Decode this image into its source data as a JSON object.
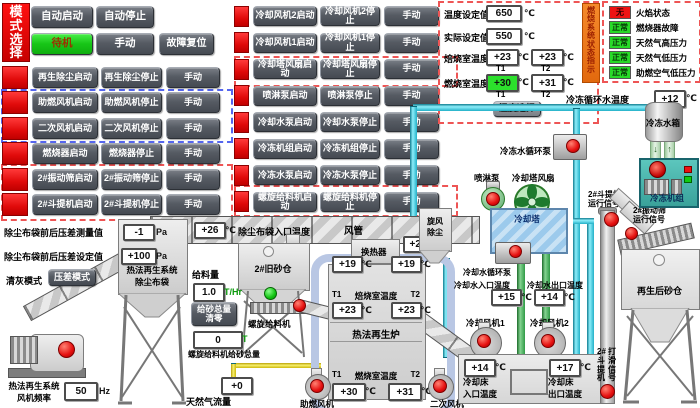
{
  "mode": {
    "title": "模式选择",
    "auto_start": "自动启动",
    "auto_stop": "自动停止",
    "standby": "待机",
    "manual": "手动",
    "fault_reset": "故障复位"
  },
  "left_rows": [
    {
      "start": "再生除尘启动",
      "stop": "再生除尘停止",
      "manual": "手动"
    },
    {
      "start": "助燃风机启动",
      "stop": "助燃风机停止",
      "manual": "手动"
    },
    {
      "start": "二次风机启动",
      "stop": "二次风机停止",
      "manual": "手动"
    },
    {
      "start": "燃烧器启动",
      "stop": "燃烧器停止",
      "manual": "手动"
    },
    {
      "start": "2#振动筛启动",
      "stop": "2#振动筛停止",
      "manual": "手动"
    },
    {
      "start": "2#斗提机启动",
      "stop": "2#斗提机停止",
      "manual": "手动"
    }
  ],
  "mid_rows": [
    {
      "start": "冷却风机2启动",
      "stop": "冷却风机2停止",
      "manual": "手动"
    },
    {
      "start": "冷却风机1启动",
      "stop": "冷却风机1停止",
      "manual": "手动"
    },
    {
      "start": "冷却塔风扇启动",
      "stop": "冷却塔风扇停止",
      "manual": "手动"
    },
    {
      "start": "喷淋泵启动",
      "stop": "喷淋泵停止",
      "manual": "手动"
    },
    {
      "start": "冷却水泵启动",
      "stop": "冷却水泵停止",
      "manual": "手动"
    },
    {
      "start": "冷冻机组启动",
      "stop": "冷冻机组停止",
      "manual": "手动"
    },
    {
      "start": "冷冻水泵启动",
      "stop": "冷冻水泵停止",
      "manual": "手动"
    },
    {
      "start": "螺旋给料机启动",
      "stop": "螺旋给料机停止",
      "manual": "手动"
    }
  ],
  "temp_panel": {
    "set_label": "温度设定值",
    "set_value": "650",
    "actual_label": "实际设定值",
    "actual_value": "550",
    "roast_label": "焙烧室温度",
    "roast_t1": "+23",
    "roast_t2": "+23",
    "burn_label": "燃烧室温度",
    "burn_t1": "+30",
    "burn_t2": "+31",
    "t1": "T1",
    "t2": "T2",
    "select_button": "温度选择"
  },
  "status_panel": {
    "side_label": "燃烧系统状态指示",
    "rows": [
      {
        "badge": "无",
        "label": "火焰状态",
        "state": "alarm"
      },
      {
        "badge": "正常",
        "label": "燃烧器故障",
        "state": "ok"
      },
      {
        "badge": "正常",
        "label": "天然气高压力",
        "state": "ok"
      },
      {
        "badge": "正常",
        "label": "天然气低压力",
        "state": "ok"
      },
      {
        "badge": "正常",
        "label": "助燃空气低压力",
        "state": "ok"
      }
    ]
  },
  "diagram": {
    "unit_c": "℃",
    "unit_pa": "Pa",
    "unit_hz": "Hz",
    "unit_t": "T",
    "unit_thr": "T/Hr",
    "chilled_temp_label": "冷冻循环水温度",
    "chilled_temp": "+12",
    "tank_label": "冷冻水箱",
    "chiller_label": "冷冻机组",
    "chilled_pump_label": "冷冻水循环泵",
    "spray_pump_label": "喷淋泵",
    "tower_fan_label": "冷却塔风扇",
    "tower_label": "冷却塔",
    "cooling_pump_label": "冷却水循环泵",
    "cw_in_label": "冷却水入口温度",
    "cw_in": "+15",
    "cw_out_label": "冷却水出口温度",
    "cw_out": "+14",
    "fan1_label": "冷却风机1",
    "fan2_label": "冷却风机2",
    "bed_in_label": "冷却床\n入口温度",
    "bed_in": "+14",
    "bed_out_label": "冷却床\n出口温度",
    "bed_out": "+17",
    "elev_run_label": "2#斗提机\n运行信号",
    "screen_run_label": "2#振动筛\n运行信号",
    "elev_slip_l1": "2#斗提机",
    "elev_slip_l2": "打滑信号",
    "sand_silo_label": "再生后砂仓",
    "cyclone_label": "旋风\n除尘",
    "duct_label": "风管",
    "duct_in": "+26",
    "duct_in_label": "除尘布袋入口温度",
    "duct_out": "+22",
    "hx_label": "换热器",
    "hx_t1": "+19",
    "hx_t2": "+19",
    "furnace_label": "热法再生炉",
    "t1": "T1",
    "t2": "T2",
    "roast_label": "焙烧室温度",
    "roast_t1": "+23",
    "roast_t2": "+23",
    "burn_label": "燃烧室温度",
    "burn_t1": "+30",
    "burn_t2": "+31",
    "aux_fan_label": "助燃风机",
    "sec_fan_label": "二次风机",
    "gas_flow_label": "天然气流量",
    "gas_flow": "+0",
    "old_silo_label": "2#旧砂仓",
    "feeder_label": "螺旋给料机",
    "feed_rate_label": "给料量",
    "feed_rate": "1.0",
    "feed_reset_label": "给砂总量\n清零",
    "feed_total": "0",
    "feed_total_label": "螺旋给料机给砂总量",
    "dp_meas_label": "除尘布袋前后压差测量值",
    "dp_meas": "-1",
    "dp_set_label": "除尘布袋前后压差设定值",
    "dp_set": "+100",
    "clean_mode_label": "清灰模式",
    "clean_mode_value": "压差模式",
    "baghouse_label": "热法再生系统\n除尘布袋",
    "fan_freq_label": "热法再生系统\n风机频率",
    "fan_freq": "50"
  }
}
